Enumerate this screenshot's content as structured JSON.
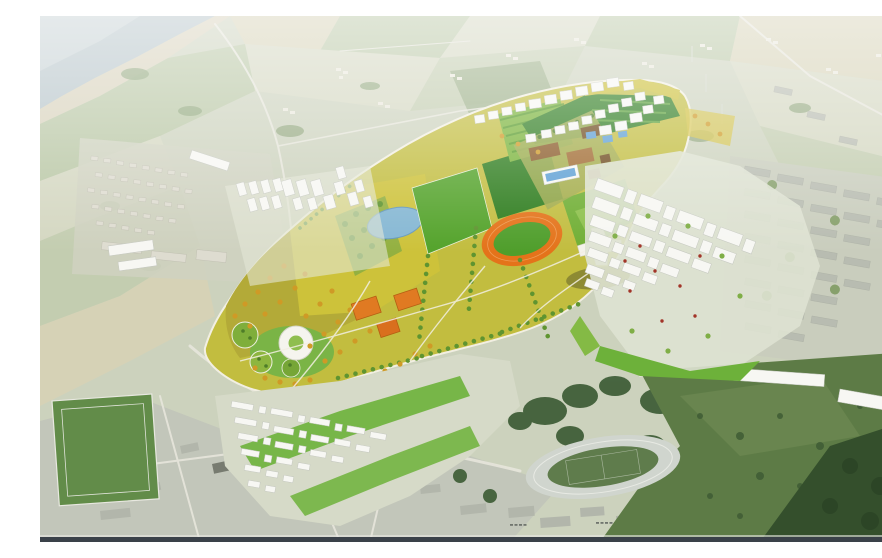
{
  "scene": {
    "type": "aerial-masterplan-rendering",
    "description": "Bird's-eye architectural rendering of an urban masterplan: a large colourful central park with sports pitches, an orange running track, a pond, a ring-shaped landmark building and a star-shaped pavilion, bordered by new white-modelled housing clusters that blend into an existing grey town, farmland, woods, an existing stadium and a coastline in the upper left.",
    "visible_text": []
  },
  "palette": {
    "sea": "#b6c4c9",
    "sea_light": "#c5d0d3",
    "sand": "#d8d2bc",
    "land": "#ccd2bd",
    "field_pale": "#d4d7c1",
    "field_beige": "#d6d2b6",
    "field_green": "#b9c7a5",
    "field_sage": "#c3cdb0",
    "copse": "#8ea57a",
    "road": "#e7e6dc",
    "village_bldg": "#eae8dc",
    "suburb_house": "#dedcd0",
    "suburb_edge": "#b5b4a6",
    "town_block": "#b8bcb1",
    "town_edge": "#a5a99e",
    "grey_block": "#b2b6ab",
    "bldg_white": "#f7f7f3",
    "bldg_edge": "#c5c8c0",
    "park_base": "#c2bd3f",
    "park_path": "#f2efe2",
    "olive_meadow": "#b3aa38",
    "yellow_meadow": "#cdc23a",
    "pitch_green": "#54a32b",
    "pitch_dark": "#2e7d1e",
    "pitch_mid": "#6fae33",
    "stripe_field": "#79b339",
    "stripe_dark": "#4e9426",
    "pond": "#85b7d3",
    "pool_blue": "#5d9fd4",
    "track_orange": "#e4731a",
    "court_orange": "#e07a22",
    "campus_brown": "#8a5a28",
    "campus_brown2": "#a06a30",
    "campus_dark": "#6e4a1e",
    "tree_green": "#5f9430",
    "tree_orange": "#cf9a26",
    "tree_dark": "#4e7d28",
    "avenue_green": "#2f7d21",
    "city_green": "#6db13a",
    "woods": "#42603a",
    "meadow_dark": "#5d7b46",
    "forest": "#344f2c",
    "stadium_track": "#d0d5ce",
    "stadium_infield": "#5f7c4c",
    "accent_red": "#a23428",
    "bottom_bar": "#3a4149"
  }
}
